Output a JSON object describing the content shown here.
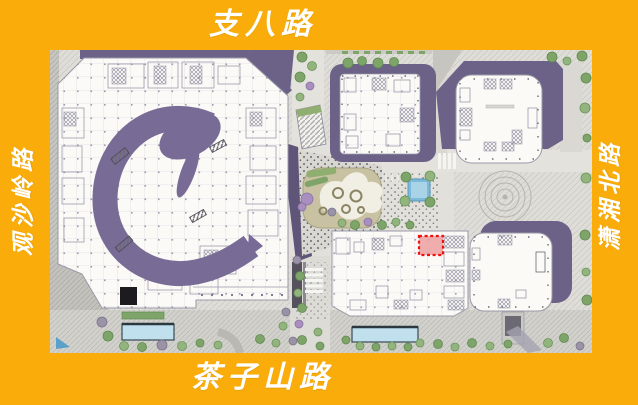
{
  "frame": {
    "background_color": "#FAAD0A",
    "label_color": "#FFFFFF"
  },
  "roads": {
    "top": "支八路",
    "bottom": "茶子山路",
    "left": "观沙岭路",
    "right": "潇湘北路"
  },
  "map": {
    "kind": "architectural site master plan (ground floor plan with landscape)",
    "highlight_marker": {
      "shape": "dashed rectangle",
      "stroke": "#F10F0F",
      "fill": "#EE9A9A"
    },
    "colors": {
      "roof_purple": "#6C6288",
      "atrium_swoosh_purple": "#786C96",
      "walkway_dark_purple": "#5E5578",
      "pavement": "#DEDDD7",
      "building_white": "#FBFAF7",
      "water_blue": "#7DB9D9",
      "tree_green": "#7FA46A"
    }
  }
}
